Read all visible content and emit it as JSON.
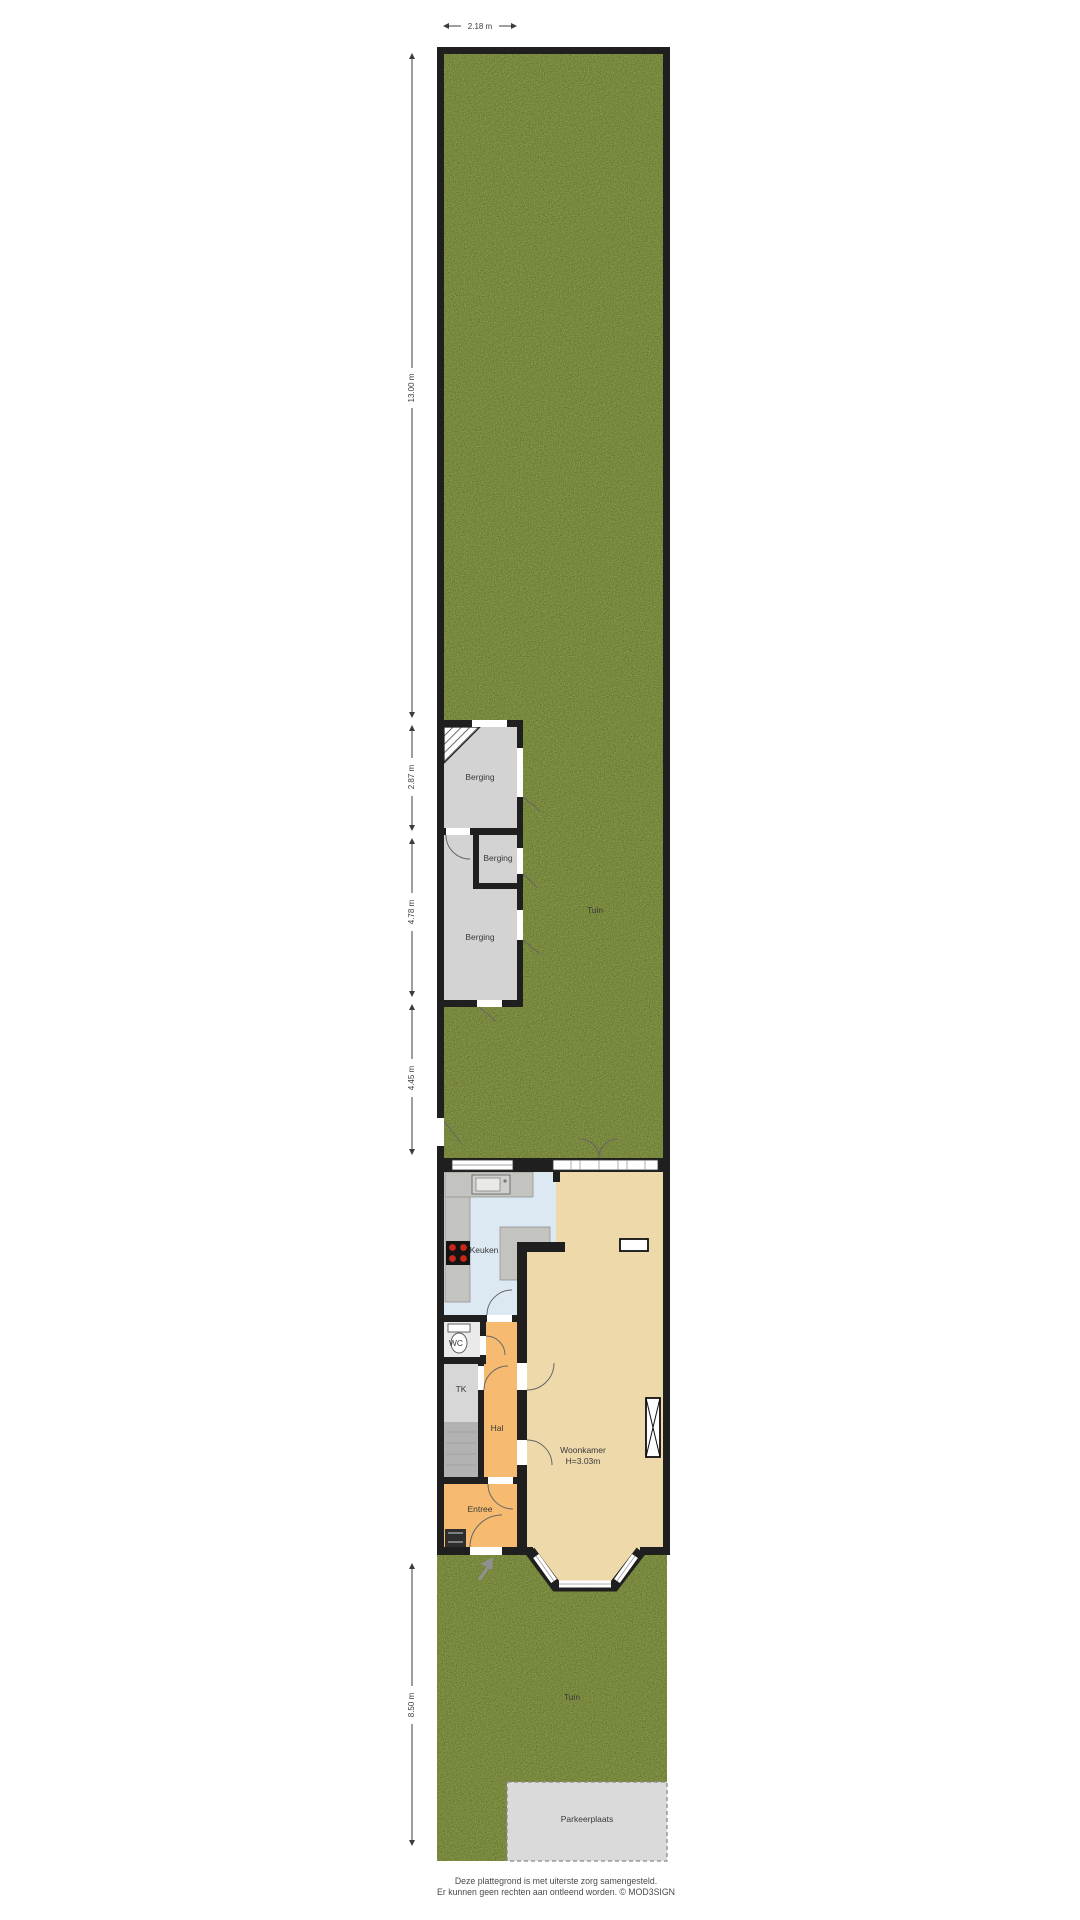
{
  "dimensions": {
    "top_width": "2.18 m",
    "seg_back_garden": "13.00 m",
    "seg_berging_top": "2.87 m",
    "seg_berging_bottom": "4.78 m",
    "seg_mid_garden": "4.45 m",
    "seg_front_garden": "8.50 m"
  },
  "rooms": {
    "berging_top": "Berging",
    "berging_middle": "Berging",
    "berging_bottom": "Berging",
    "tuin_back": "Tuin",
    "keuken": "Keuken",
    "wc": "WC",
    "tk": "TK",
    "hal": "Hal",
    "woonkamer": "Woonkamer",
    "woonkamer_height": "H=3.03m",
    "entree": "Entree",
    "tuin_front": "Tuin",
    "parkeerplaats": "Parkeerplaats"
  },
  "footer": {
    "line1": "Deze plattegrond is met uiterste zorg samengesteld.",
    "line2": "Er kunnen geen rechten aan ontleend worden. © MOD3SIGN"
  },
  "colors": {
    "wall": "#1f1f1f",
    "grass": "#7e9140",
    "berging_floor": "#d3d3d3",
    "keuken_floor": "#dce8f2",
    "woonkamer_floor": "#eed9ab",
    "hal_floor": "#f6bb70",
    "entree_floor": "#f6bb70",
    "wc_floor": "#eaeaea",
    "tk_floor_top": "#d7d7d7",
    "tk_floor_bottom": "#b2b2b2",
    "counter": "#c3c3c0",
    "parking": "#dadada",
    "stove": "#141414",
    "burner": "#c8281a"
  }
}
